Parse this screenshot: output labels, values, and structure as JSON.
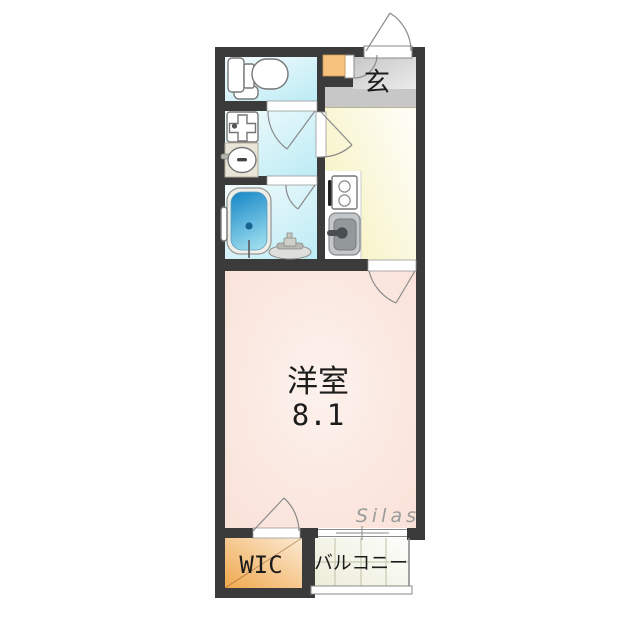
{
  "plan": {
    "labels": {
      "entrance": "玄",
      "room_name": "洋室",
      "room_size": "8.1",
      "wic": "WIC",
      "balcony": "バルコニー"
    },
    "watermark": "Silas",
    "colors": {
      "wall": "#3b3b3b",
      "wet_floor": "#bfecf5",
      "entrance_floor": "#c7c7c7",
      "kitchen_floor": "#f6f1bd",
      "room_floor": "#f9e1d7",
      "wic_floor": "#f0a94f",
      "balcony_floor": "#ecedd9",
      "shoe_cabinet": "#f6c27e",
      "bathtub_deep": "#1f8cc9",
      "bathtub_light": "#9bdcee",
      "label_text": "#1c1c1c",
      "watermark_text": "#9b9b9b"
    }
  }
}
